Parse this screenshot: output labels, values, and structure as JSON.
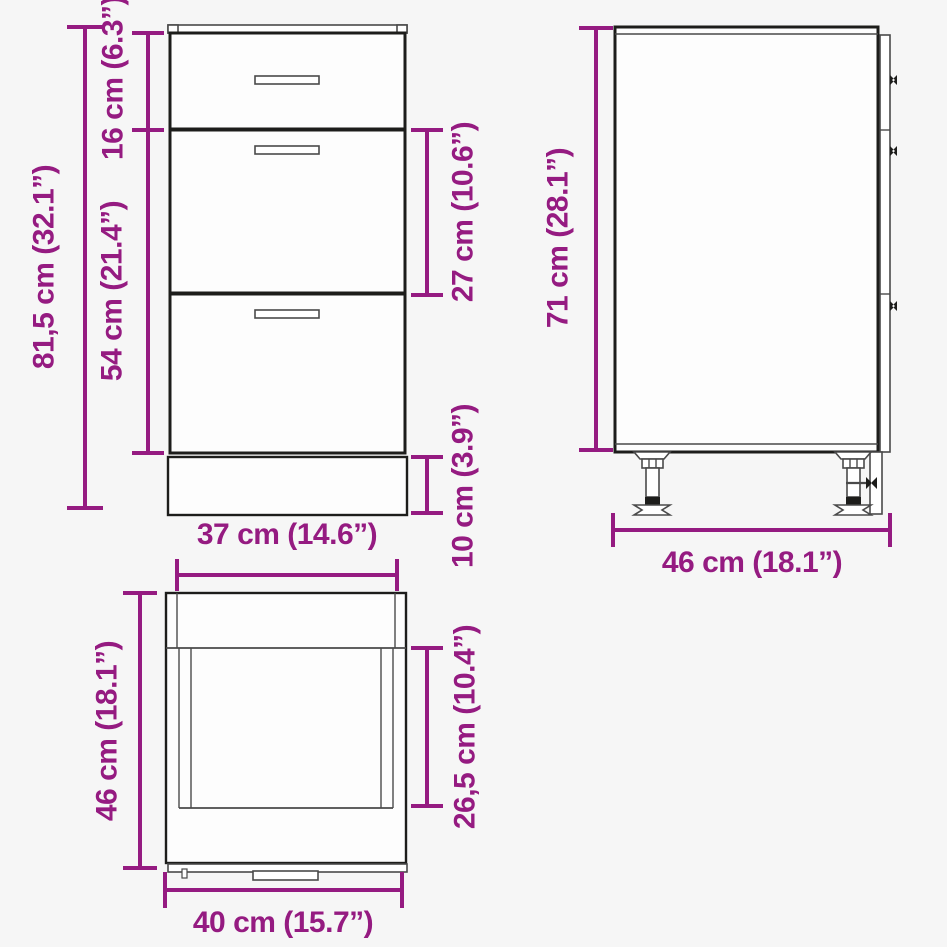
{
  "colors": {
    "accent": "#951b81",
    "line": "#1d1d1b",
    "background": "#f6f6f6"
  },
  "views": {
    "front": {
      "dims": {
        "total_height": "81,5 cm (32.1”)",
        "top_drawer_height": "16 cm (6.3”)",
        "lower_drawers_height": "54 cm (21.4”)",
        "middle_drawer_height": "27 cm (10.6”)",
        "plinth_height": "10 cm (3.9”)",
        "front_width": "37 cm (14.6”)"
      }
    },
    "side": {
      "dims": {
        "height": "71 cm (28.1”)",
        "depth": "46 cm (18.1”)"
      }
    },
    "top": {
      "dims": {
        "depth": "46 cm (18.1”)",
        "drawer_inner_depth": "26,5 cm (10.4”)",
        "width": "40 cm (15.7”)"
      }
    }
  }
}
